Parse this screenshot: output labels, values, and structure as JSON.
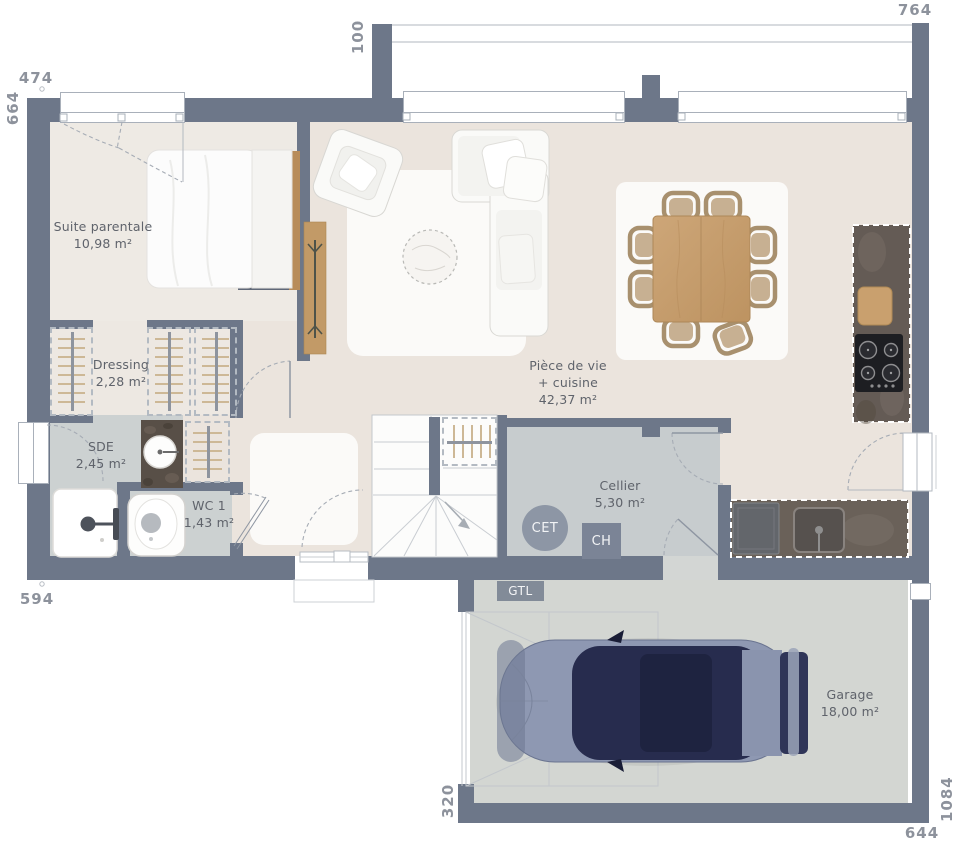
{
  "rooms": [
    {
      "key": "suite-parentale",
      "name": "Suite parentale",
      "area": "10,98 m²"
    },
    {
      "key": "dressing",
      "name": "Dressing",
      "area": "2,28 m²"
    },
    {
      "key": "sde",
      "name": "SDE",
      "area": "2,45 m²"
    },
    {
      "key": "wc1",
      "name": "WC 1",
      "area": "1,43 m²"
    },
    {
      "key": "piece-de-vie",
      "line1": "Pièce de vie",
      "line2": "+ cuisine",
      "area": "42,37 m²"
    },
    {
      "key": "cellier",
      "name": "Cellier",
      "area": "5,30 m²"
    },
    {
      "key": "garage",
      "name": "Garage",
      "area": "18,00 m²"
    }
  ],
  "equipment": {
    "cet": "CET",
    "ch": "CH",
    "gtl": "GTL"
  },
  "dimensions_cm": {
    "top_left": "474",
    "top_porch": "100",
    "top_right": "764",
    "left": "664",
    "bottom_left": "594",
    "garage_left": "320",
    "garage_bottom": "644",
    "right": "1084"
  },
  "colors": {
    "wall": "#6d7789",
    "floor_main": "#ebe4dd",
    "floor_bedroom": "#eeeae4",
    "floor_wet": "#ccd1d1",
    "floor_cellier": "#c7ccce",
    "floor_garage": "#d3d6d2",
    "counter_dark": "#645b55",
    "wood": "#c69e6f",
    "car_body": "#8e98b2",
    "car_roof": "#272c4e",
    "equipment_slate": "#8d96a5"
  }
}
